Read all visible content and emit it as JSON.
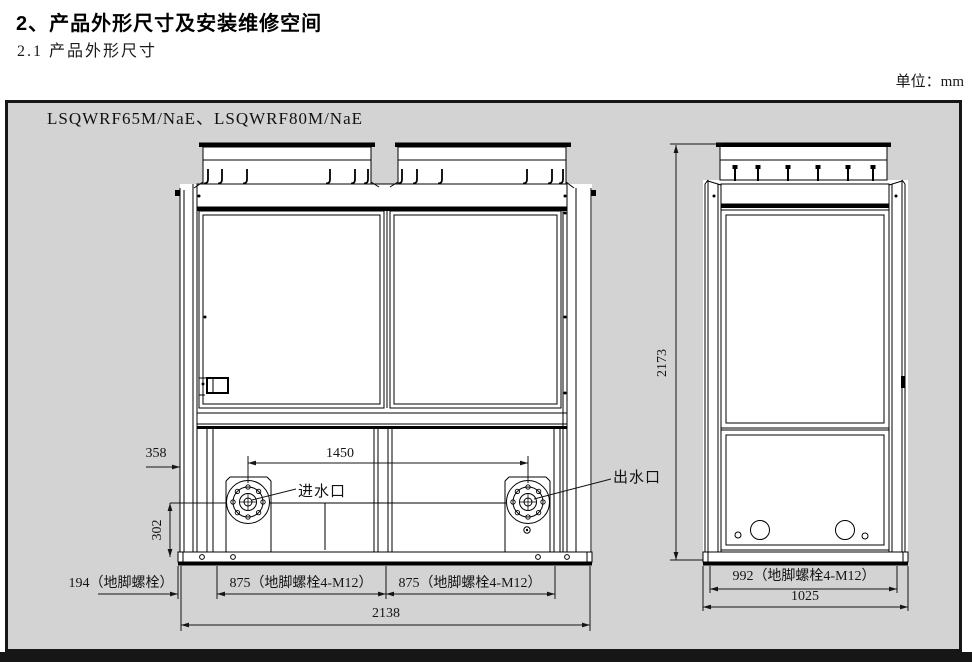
{
  "page": {
    "title": "2、产品外形尺寸及安装维修空间",
    "subtitle": "2.1 产品外形尺寸",
    "unit_note": "单位：mm"
  },
  "diagram": {
    "model_label": "LSQWRF65M/NaE、LSQWRF80M/NaE",
    "labels": {
      "water_inlet": "进水口",
      "water_outlet": "出水口"
    },
    "front_dimensions": {
      "inlet_outlet_spacing": "1450",
      "port_side_offset": "358",
      "port_height": "302",
      "anchor_left": "194（地脚螺栓）",
      "anchor_span_left": "875（地脚螺栓4-M12）",
      "anchor_span_right": "875（地脚螺栓4-M12）",
      "overall_width": "2138"
    },
    "side_dimensions": {
      "overall_height": "2173",
      "anchor_span": "992（地脚螺栓4-M12）",
      "overall_depth": "1025"
    },
    "colors": {
      "canvas_bg": "#d3d3d3",
      "line": "#000000",
      "unit_fill": "#ffffff"
    }
  }
}
